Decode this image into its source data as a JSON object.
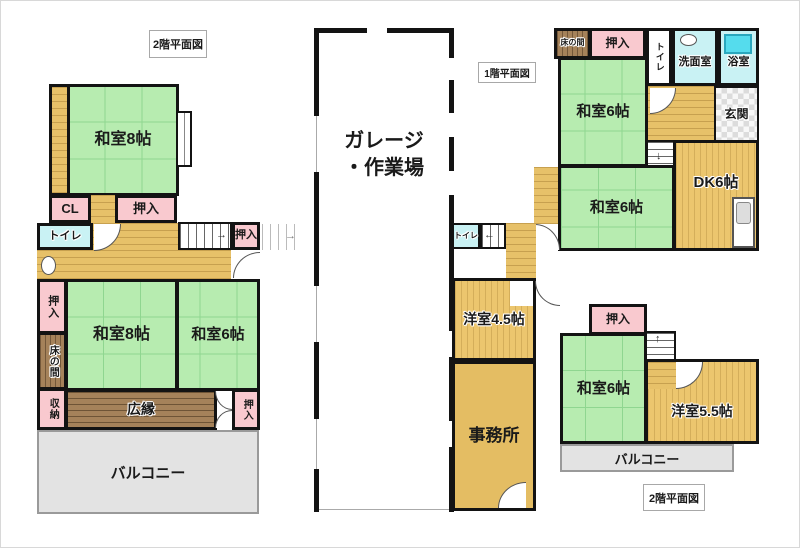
{
  "titles": {
    "left_plan": "2階平面図",
    "first_floor": "1階平面図",
    "right_plan": "2階平面図"
  },
  "garage": {
    "line1": "ガレージ",
    "line2": "・作業場"
  },
  "rooms": {
    "washitsu8_top": "和室8帖",
    "cl": "CL",
    "oshiire_top": "押入",
    "toilet_2f_left": "トイレ",
    "oshiire_stair": "押入",
    "oshiire_left": "押入",
    "tokonoma_left": "床の間",
    "shuno": "収納",
    "washitsu8": "和室8帖",
    "washitsu6_left": "和室6帖",
    "hiroen": "広縁",
    "oshiire_br": "押入",
    "balcony_left": "バルコニー",
    "tokonoma_1f": "床の間",
    "oshiire_1f": "押入",
    "toilet_1f": "トイレ",
    "senmenshitsu": "洗面室",
    "yokushitsu": "浴室",
    "washitsu6_1f_a": "和室6帖",
    "genkan": "玄関",
    "dk": "DK6帖",
    "washitsu6_1f_b": "和室6帖",
    "toilet_1f_b": "トイレ",
    "yoshitsu45": "洋室4.5帖",
    "jimusho": "事務所",
    "oshiire_2f": "押入",
    "washitsu6_2f": "和室6帖",
    "yoshitsu55": "洋室5.5帖",
    "balcony_2f": "バルコニー"
  },
  "icons": {
    "arrow_right": "→",
    "arrow_left": "←",
    "arrow_up": "↑",
    "arrow_down": "↓"
  },
  "colors": {
    "tatami_green": "#b7ecb0",
    "closet_pink": "#f9c9cf",
    "water_cyan": "#c9f2f4",
    "tub_cyan": "#55dced",
    "wood_tan": "#e7c169",
    "wood_dark": "#a5825a",
    "balcony_gray": "#e3e3e3",
    "wall_black": "#131313"
  }
}
